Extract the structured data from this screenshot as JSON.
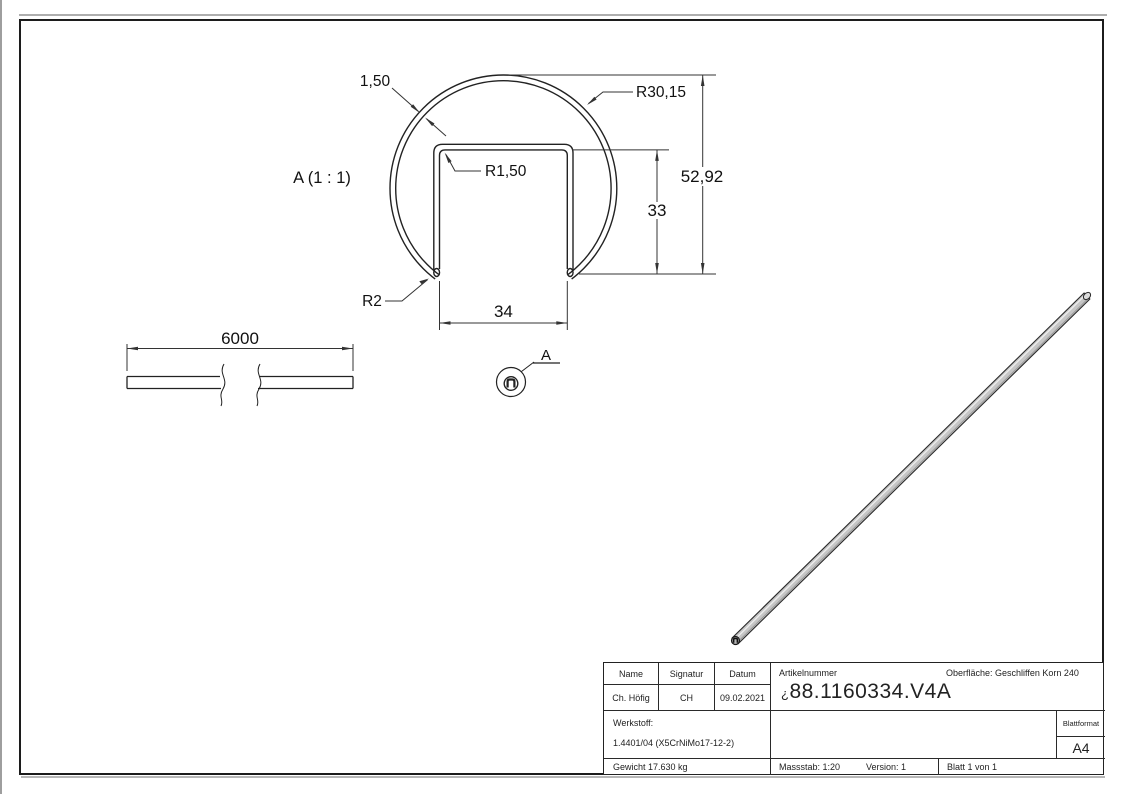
{
  "sheet": {
    "view_label": "A (1 : 1)",
    "detail_ref": "A",
    "dims": {
      "wall_thickness": "1,50",
      "outer_radius": "R30,15",
      "inner_corner_radius": "R1,50",
      "overall_height": "52,92",
      "slot_depth": "33",
      "slot_width": "34",
      "leg_radius": "R2",
      "length": "6000"
    }
  },
  "title_block": {
    "name_header": "Name",
    "signatur_header": "Signatur",
    "datum_header": "Datum",
    "name": "Ch. Höfig",
    "signatur": "CH",
    "datum": "09.02.2021",
    "artikelnummer_label": "Artikelnummer",
    "artikelnummer_prefix": "¿",
    "artikelnummer": "88.1160334.V4A",
    "oberflaeche": "Oberfläche:  Geschliffen Korn 240",
    "werkstoff_label": "Werkstoff:",
    "werkstoff": "1.4401/04 (X5CrNiMo17-12-2)",
    "blattformat_label": "Blattformat",
    "blattformat": "A4",
    "gewicht": "Gewicht 17.630 kg",
    "massstab": "Massstab: 1:20",
    "version": "Version: 1",
    "blatt": "Blatt 1 von 1"
  },
  "colors": {
    "line": "#222222",
    "dim_line": "#333333",
    "rod_fill": "#c6c6c6",
    "paper": "#ffffff"
  }
}
